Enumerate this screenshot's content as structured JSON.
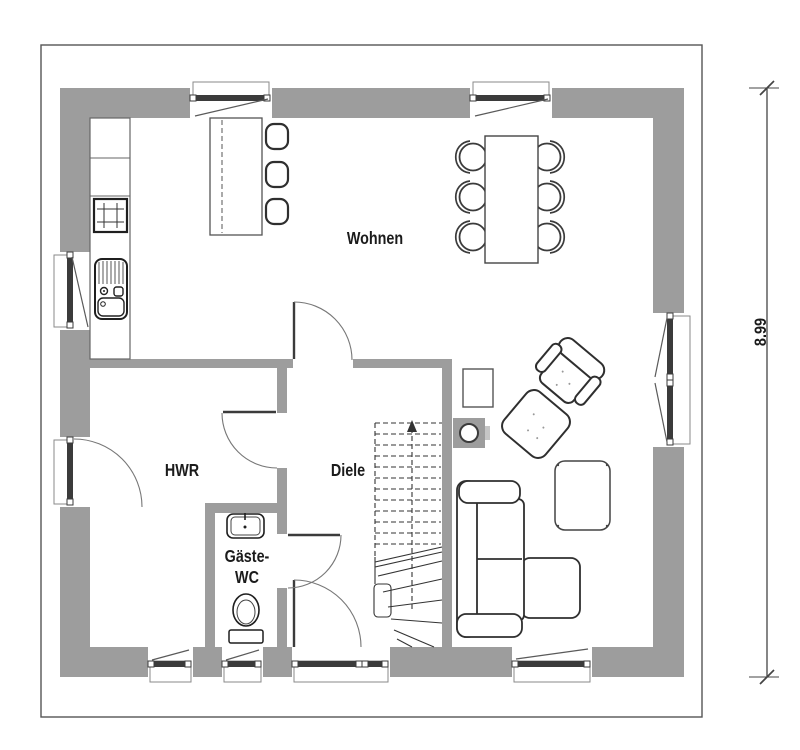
{
  "plan": {
    "title": "ground-floor-plan",
    "rooms": [
      {
        "name": "living-room",
        "label": "Wohnen"
      },
      {
        "name": "utility-room",
        "label": "HWR"
      },
      {
        "name": "hallway",
        "label": "Diele"
      },
      {
        "name": "guest-wc",
        "label_line1": "Gäste-",
        "label_line2": "WC"
      }
    ],
    "dimension": {
      "value": "8.99",
      "orientation": "vertical",
      "side": "right"
    },
    "colors": {
      "wall": "#9d9d9d",
      "line": "#3b3b3b",
      "background": "#ffffff"
    },
    "icons": [
      "kitchen-counter",
      "hob",
      "kitchen-sink",
      "kitchen-island",
      "bar-stool",
      "dining-table",
      "dining-chair",
      "window",
      "entrance-door",
      "interior-door",
      "staircase",
      "fireplace",
      "side-table",
      "armchair",
      "ottoman",
      "coffee-table",
      "corner-sofa",
      "toilet",
      "washbasin"
    ]
  }
}
